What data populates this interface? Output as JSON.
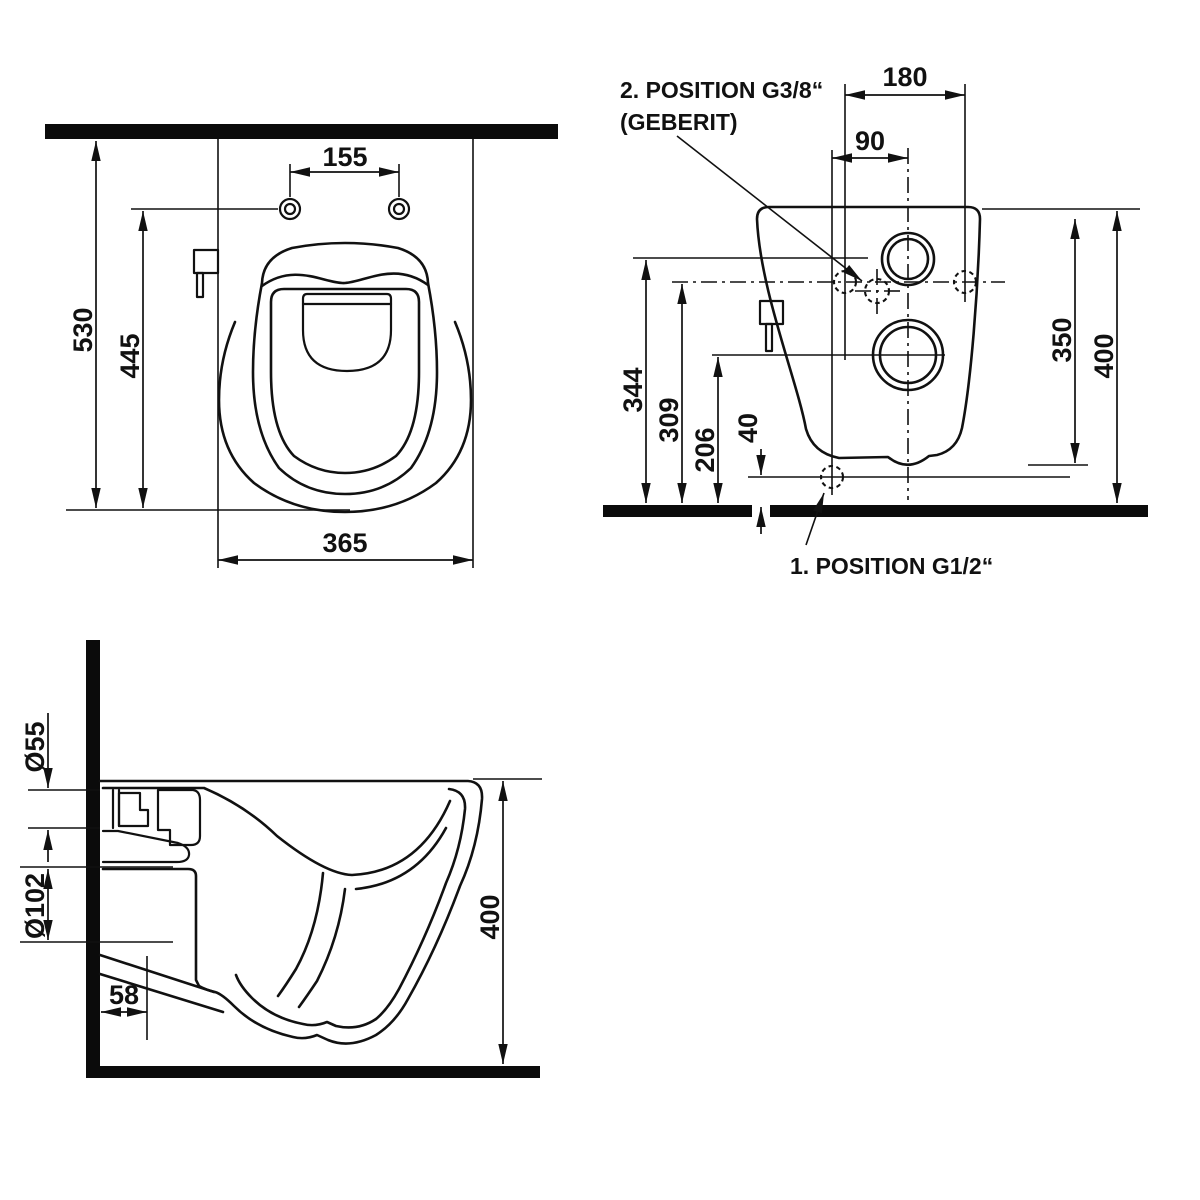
{
  "drawing": {
    "top_view": {
      "dim_hole_spacing": "155",
      "dim_depth_total": "530",
      "dim_depth_to_holes": "445",
      "dim_width": "365"
    },
    "front_view": {
      "dim_fixing_span": "180",
      "dim_inlet_offset": "90",
      "dim_344": "344",
      "dim_309": "309",
      "dim_206": "206",
      "dim_40": "40",
      "dim_350": "350",
      "dim_400": "400",
      "label_pos2_line1": "2. POSITION G3/8“",
      "label_pos2_line2": "(GEBERIT)",
      "label_pos1": "1. POSITION G1/2“"
    },
    "side_view": {
      "dim_inlet_diameter": "Ø55",
      "dim_outlet_diameter": "Ø102",
      "dim_58": "58",
      "dim_400": "400"
    }
  }
}
